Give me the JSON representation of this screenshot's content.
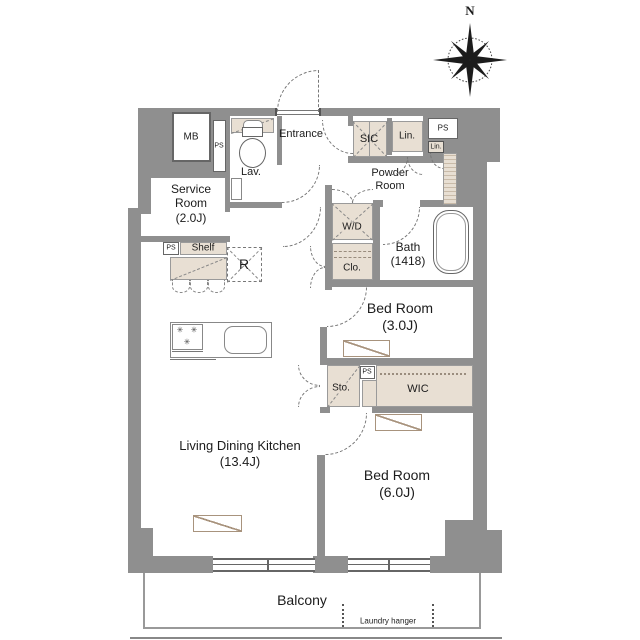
{
  "compass": {
    "north": "N"
  },
  "rooms": {
    "entrance": {
      "name": "Entrance"
    },
    "lavatory": {
      "name": "Lav."
    },
    "service_room": {
      "name": "Service Room",
      "size": "(2.0J)"
    },
    "powder_room": {
      "name": "Powder Room"
    },
    "bath": {
      "name": "Bath",
      "size": "(1418)"
    },
    "bedroom_3j": {
      "name": "Bed Room",
      "size": "(3.0J)"
    },
    "bedroom_6j": {
      "name": "Bed Room",
      "size": "(6.0J)"
    },
    "ldk": {
      "name": "Living Dining Kitchen",
      "size": "(13.4J)"
    },
    "balcony": {
      "name": "Balcony"
    },
    "laundry_hanger": {
      "label": "Laundry hanger"
    }
  },
  "storage": {
    "sic": {
      "label": "SIC"
    },
    "linen": {
      "label": "Lin."
    },
    "linen_small": {
      "label": "Lin."
    },
    "washer_dryer": {
      "label": "W/D"
    },
    "closet": {
      "label": "Clo."
    },
    "storage_sto": {
      "label": "Sto."
    },
    "wic": {
      "label": "WIC"
    },
    "shelf": {
      "label": "Shelf"
    }
  },
  "utilities": {
    "meter_box": {
      "label": "MB"
    },
    "pipe_space": {
      "label": "PS"
    },
    "refrigerator": {
      "label": "R"
    }
  },
  "colors": {
    "wall": "#8f8f8f",
    "storage_fill": "#e8dfd3",
    "outline": "#777777",
    "text": "#1c1c1c"
  }
}
